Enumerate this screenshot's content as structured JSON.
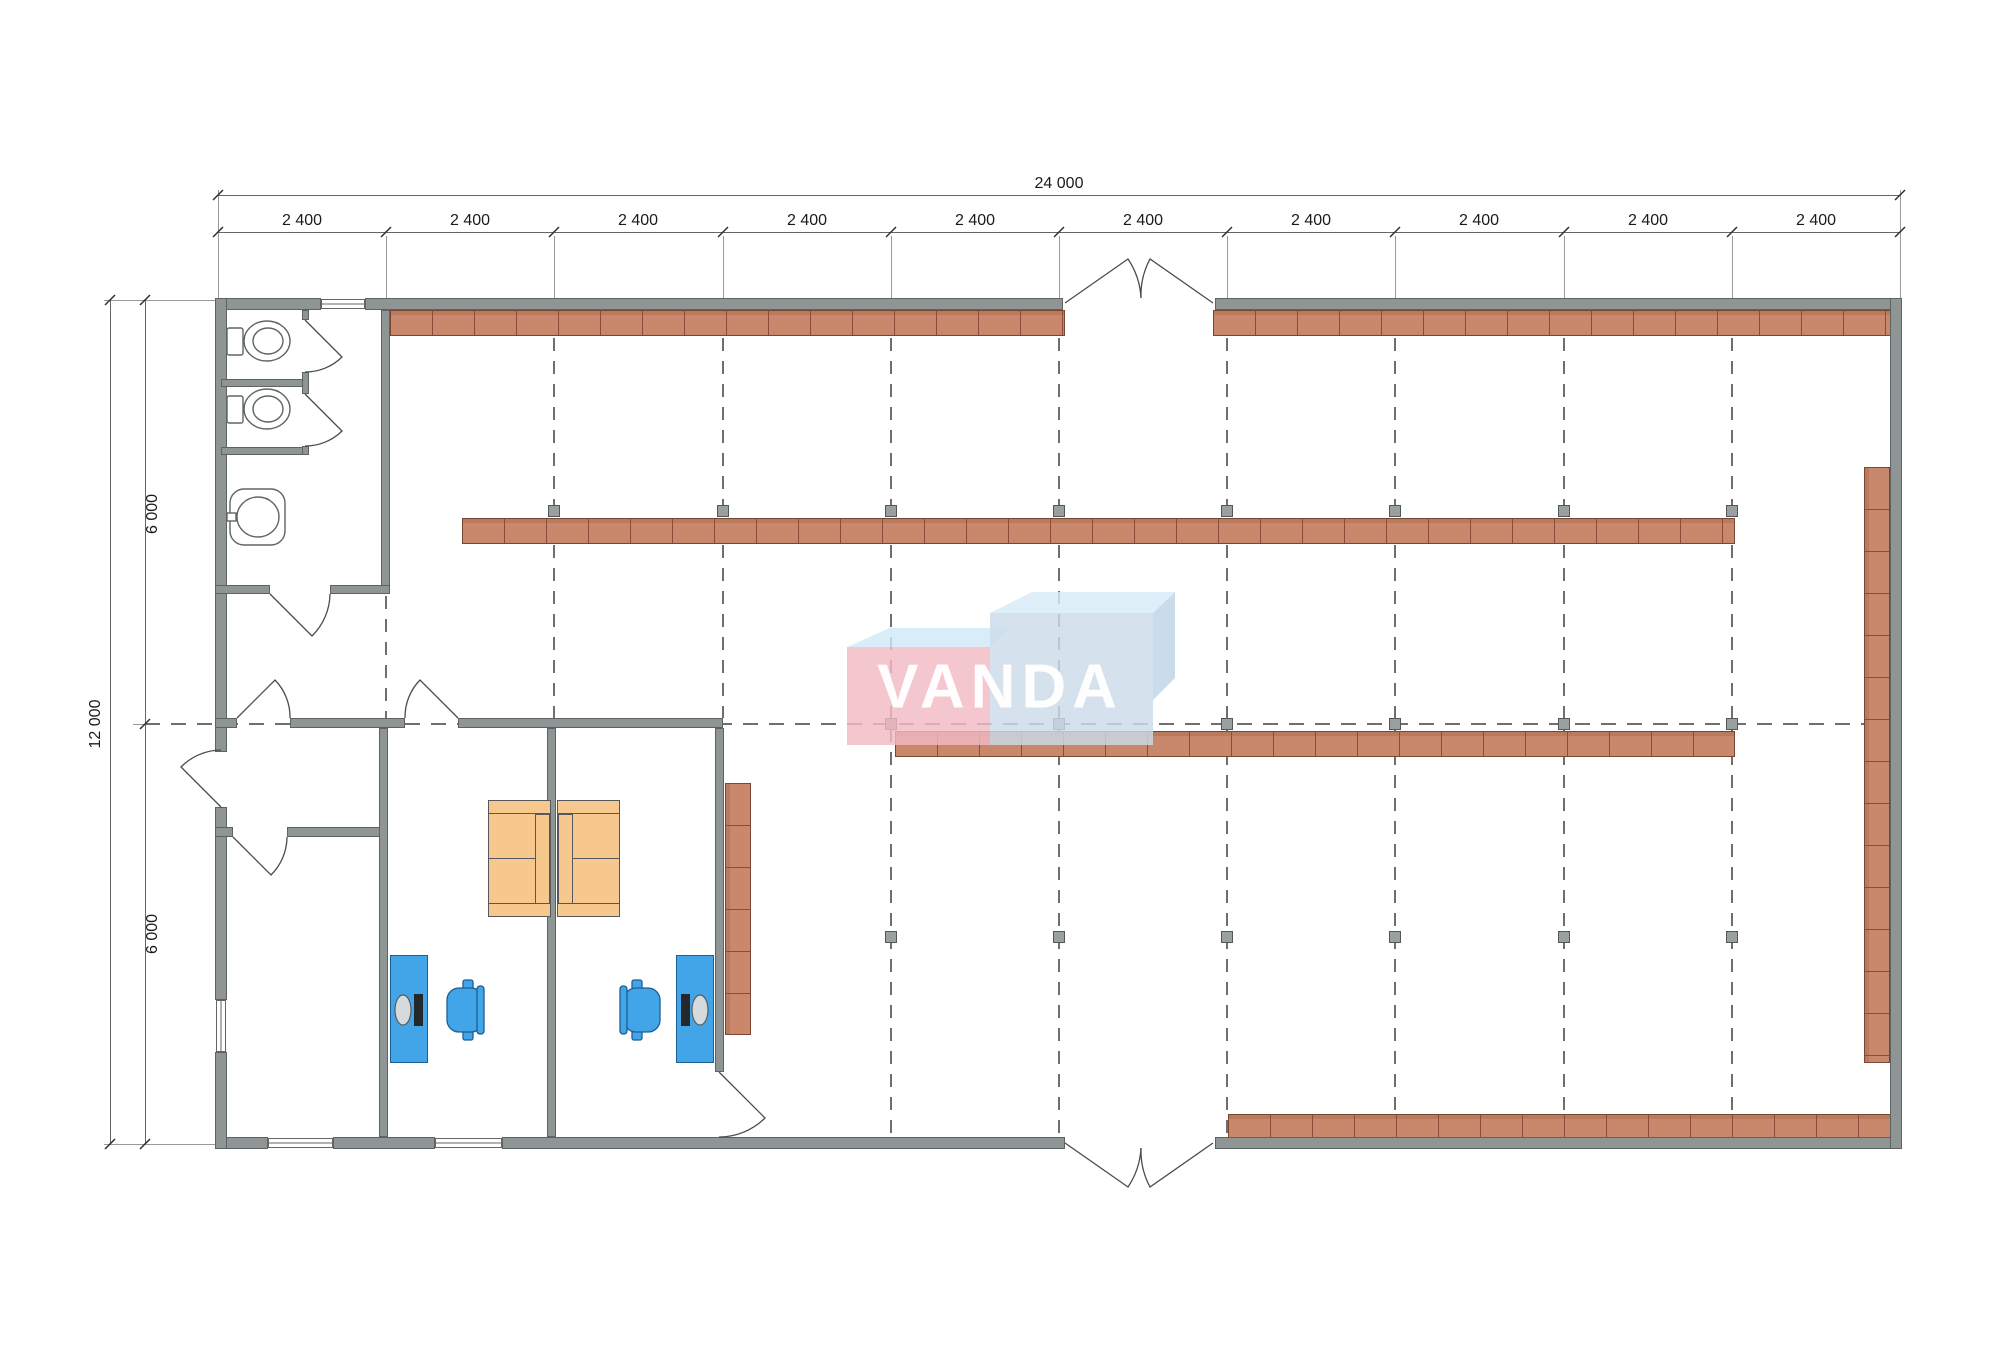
{
  "document": {
    "type": "architectural floor plan",
    "units": "mm"
  },
  "dimensions": {
    "top": {
      "total": "24 000",
      "segments": [
        "2 400",
        "2 400",
        "2 400",
        "2 400",
        "2 400",
        "2 400",
        "2 400",
        "2 400",
        "2 400",
        "2 400"
      ]
    },
    "left": {
      "total": "12 000",
      "segments": [
        "6 000",
        "6 000"
      ]
    }
  },
  "logo": {
    "text": "VANDA",
    "pink": "#f2bac3",
    "light_blue": "#ccdcea"
  },
  "colors": {
    "wall": "#8f9594",
    "shelving": "#c9876c",
    "desk": "#42a5e8",
    "sofa": "#f7c88d",
    "column": "#9aa0a0"
  }
}
